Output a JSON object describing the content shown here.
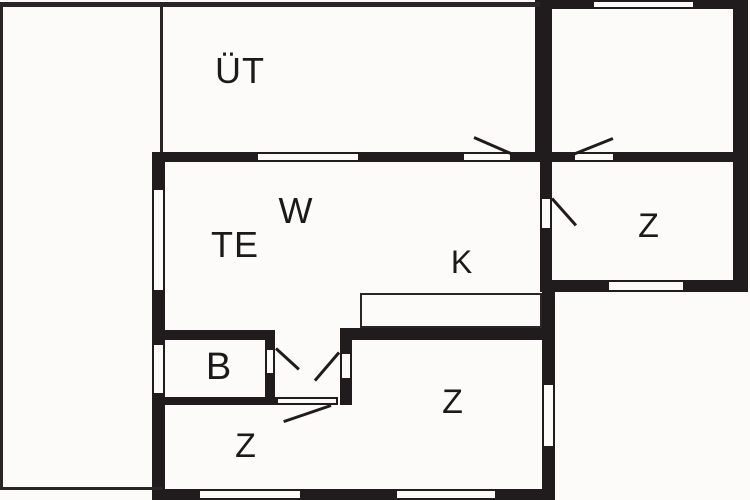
{
  "plan": {
    "type": "floor-plan",
    "colors": {
      "wall": "#201c1d",
      "thin_line": "#2a2627",
      "background": "#fcfbfa",
      "label": "#1c191a"
    },
    "rooms": [
      {
        "id": "ut",
        "label": "ÜT",
        "x": 240,
        "y": 71,
        "size": 36
      },
      {
        "id": "w",
        "label": "W",
        "x": 296,
        "y": 211,
        "size": 36
      },
      {
        "id": "te",
        "label": "TE",
        "x": 235,
        "y": 245,
        "size": 36
      },
      {
        "id": "k",
        "label": "K",
        "x": 462,
        "y": 262,
        "size": 32
      },
      {
        "id": "z-east",
        "label": "Z",
        "x": 649,
        "y": 226,
        "size": 34
      },
      {
        "id": "b",
        "label": "B",
        "x": 219,
        "y": 367,
        "size": 38
      },
      {
        "id": "z-south",
        "label": "Z",
        "x": 453,
        "y": 402,
        "size": 34
      },
      {
        "id": "z-southwest",
        "label": "Z",
        "x": 246,
        "y": 446,
        "size": 34
      }
    ],
    "geometry": {
      "walls_thick": [
        [
          537,
          0,
          55,
          9
        ],
        [
          695,
          0,
          53,
          9
        ],
        [
          733,
          0,
          15,
          292
        ],
        [
          535,
          0,
          17,
          162
        ],
        [
          152,
          152,
          104,
          10
        ],
        [
          360,
          152,
          102,
          10
        ],
        [
          512,
          152,
          40,
          10
        ],
        [
          552,
          152,
          21,
          10
        ],
        [
          615,
          152,
          133,
          10
        ],
        [
          540,
          162,
          12,
          35
        ],
        [
          540,
          230,
          12,
          62
        ],
        [
          552,
          280,
          55,
          12
        ],
        [
          685,
          280,
          63,
          12
        ],
        [
          542,
          280,
          13,
          103
        ],
        [
          542,
          448,
          13,
          52
        ],
        [
          152,
          152,
          13,
          36
        ],
        [
          152,
          292,
          13,
          51
        ],
        [
          152,
          395,
          13,
          105
        ],
        [
          152,
          489,
          46,
          11
        ],
        [
          302,
          489,
          93,
          11
        ],
        [
          497,
          489,
          58,
          11
        ],
        [
          165,
          330,
          110,
          10
        ],
        [
          165,
          397,
          113,
          8
        ],
        [
          265,
          330,
          10,
          18
        ],
        [
          265,
          375,
          10,
          30
        ],
        [
          340,
          328,
          12,
          24
        ],
        [
          340,
          380,
          12,
          25
        ],
        [
          340,
          328,
          215,
          12
        ]
      ],
      "walls_thin": [
        [
          0,
          2,
          540,
          5
        ],
        [
          0,
          2,
          3,
          488
        ],
        [
          160,
          2,
          3,
          150
        ],
        [
          0,
          487,
          162,
          3
        ]
      ],
      "windows": [
        [
          592,
          0,
          103,
          9
        ],
        [
          256,
          152,
          104,
          10
        ],
        [
          152,
          188,
          13,
          104
        ],
        [
          152,
          343,
          13,
          52
        ],
        [
          607,
          280,
          78,
          12
        ],
        [
          542,
          383,
          13,
          65
        ],
        [
          198,
          489,
          104,
          11
        ],
        [
          395,
          489,
          102,
          11
        ]
      ],
      "doors": [
        [
          462,
          152,
          50,
          10
        ],
        [
          573,
          152,
          42,
          10
        ],
        [
          540,
          197,
          12,
          33
        ],
        [
          265,
          348,
          10,
          27
        ],
        [
          340,
          352,
          12,
          28
        ],
        [
          275,
          397,
          63,
          8
        ]
      ],
      "counter": [
        [
          360,
          293,
          182,
          35
        ]
      ],
      "door_swings": [
        [
          474,
          136,
          513,
          153
        ],
        [
          573,
          153,
          613,
          137
        ],
        [
          552,
          197,
          576,
          224
        ],
        [
          276,
          347,
          299,
          368
        ],
        [
          339,
          351,
          315,
          379
        ],
        [
          331,
          404,
          284,
          420
        ]
      ]
    }
  }
}
